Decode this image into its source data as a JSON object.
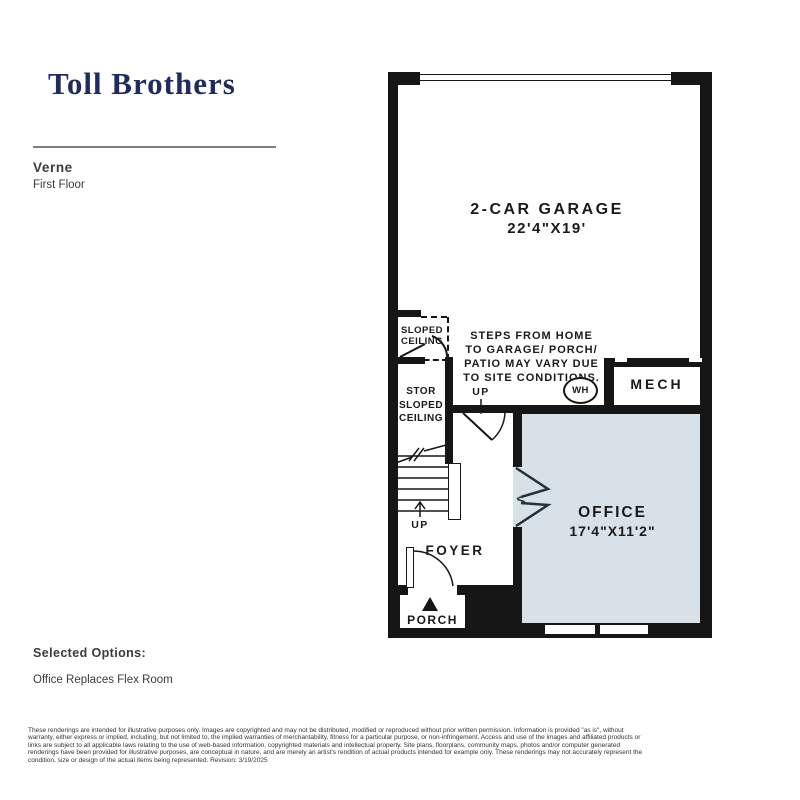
{
  "header": {
    "logo": "Toll Brothers",
    "plan_name": "Verne",
    "floor_label": "First Floor"
  },
  "floor_plan": {
    "rooms": {
      "garage": {
        "name": "2-CAR GARAGE",
        "dimensions": "22'4\"X19'"
      },
      "office": {
        "name": "OFFICE",
        "dimensions": "17'4\"X11'2\""
      },
      "mech": {
        "name": "MECH"
      },
      "foyer": {
        "name": "FOYER"
      },
      "porch": {
        "name": "PORCH"
      },
      "storage": {
        "lines": [
          "STOR",
          "SLOPED",
          "CEILING"
        ]
      },
      "sloped_ceiling": {
        "lines": [
          "SLOPED",
          "CEILING"
        ]
      }
    },
    "annotations": {
      "steps_note": [
        "STEPS FROM HOME",
        "TO GARAGE/ PORCH/",
        "PATIO MAY VARY DUE",
        "TO SITE CONDITIONS."
      ],
      "water_heater": "WH",
      "up_stairs": "UP",
      "up_garage": "UP"
    },
    "colors": {
      "wall": "#161616",
      "office_fill": "#d8e1e8",
      "logo_navy": "#1f2c5c"
    }
  },
  "options": {
    "title": "Selected Options:",
    "items": [
      "Office Replaces Flex Room"
    ]
  },
  "disclaimer": {
    "lines": [
      "These renderings are intended for illustrative purposes only. Images are copyrighted and may not be distributed, modified or reproduced without prior written permission. Information is provided \"as is\", without",
      "warranty, either express or implied, including, but not limited to, the implied warranties of merchantability, fitness for a particular purpose, or non-infringement. Access and use of the images and affiliated products or",
      "links are subject to all applicable laws relating to the use of web-based information, copyrighted materials and intellectual property. Site plans, floorplans, community maps, photos and/or computer generated",
      "renderings have been provided for illustrative purposes, are conceptual in nature, and are merely an artist's rendition of actual products intended for example only. These renderings may not accurately represent the",
      "condition, size or design of the actual items being represented. Revision: 3/19/2025"
    ]
  }
}
